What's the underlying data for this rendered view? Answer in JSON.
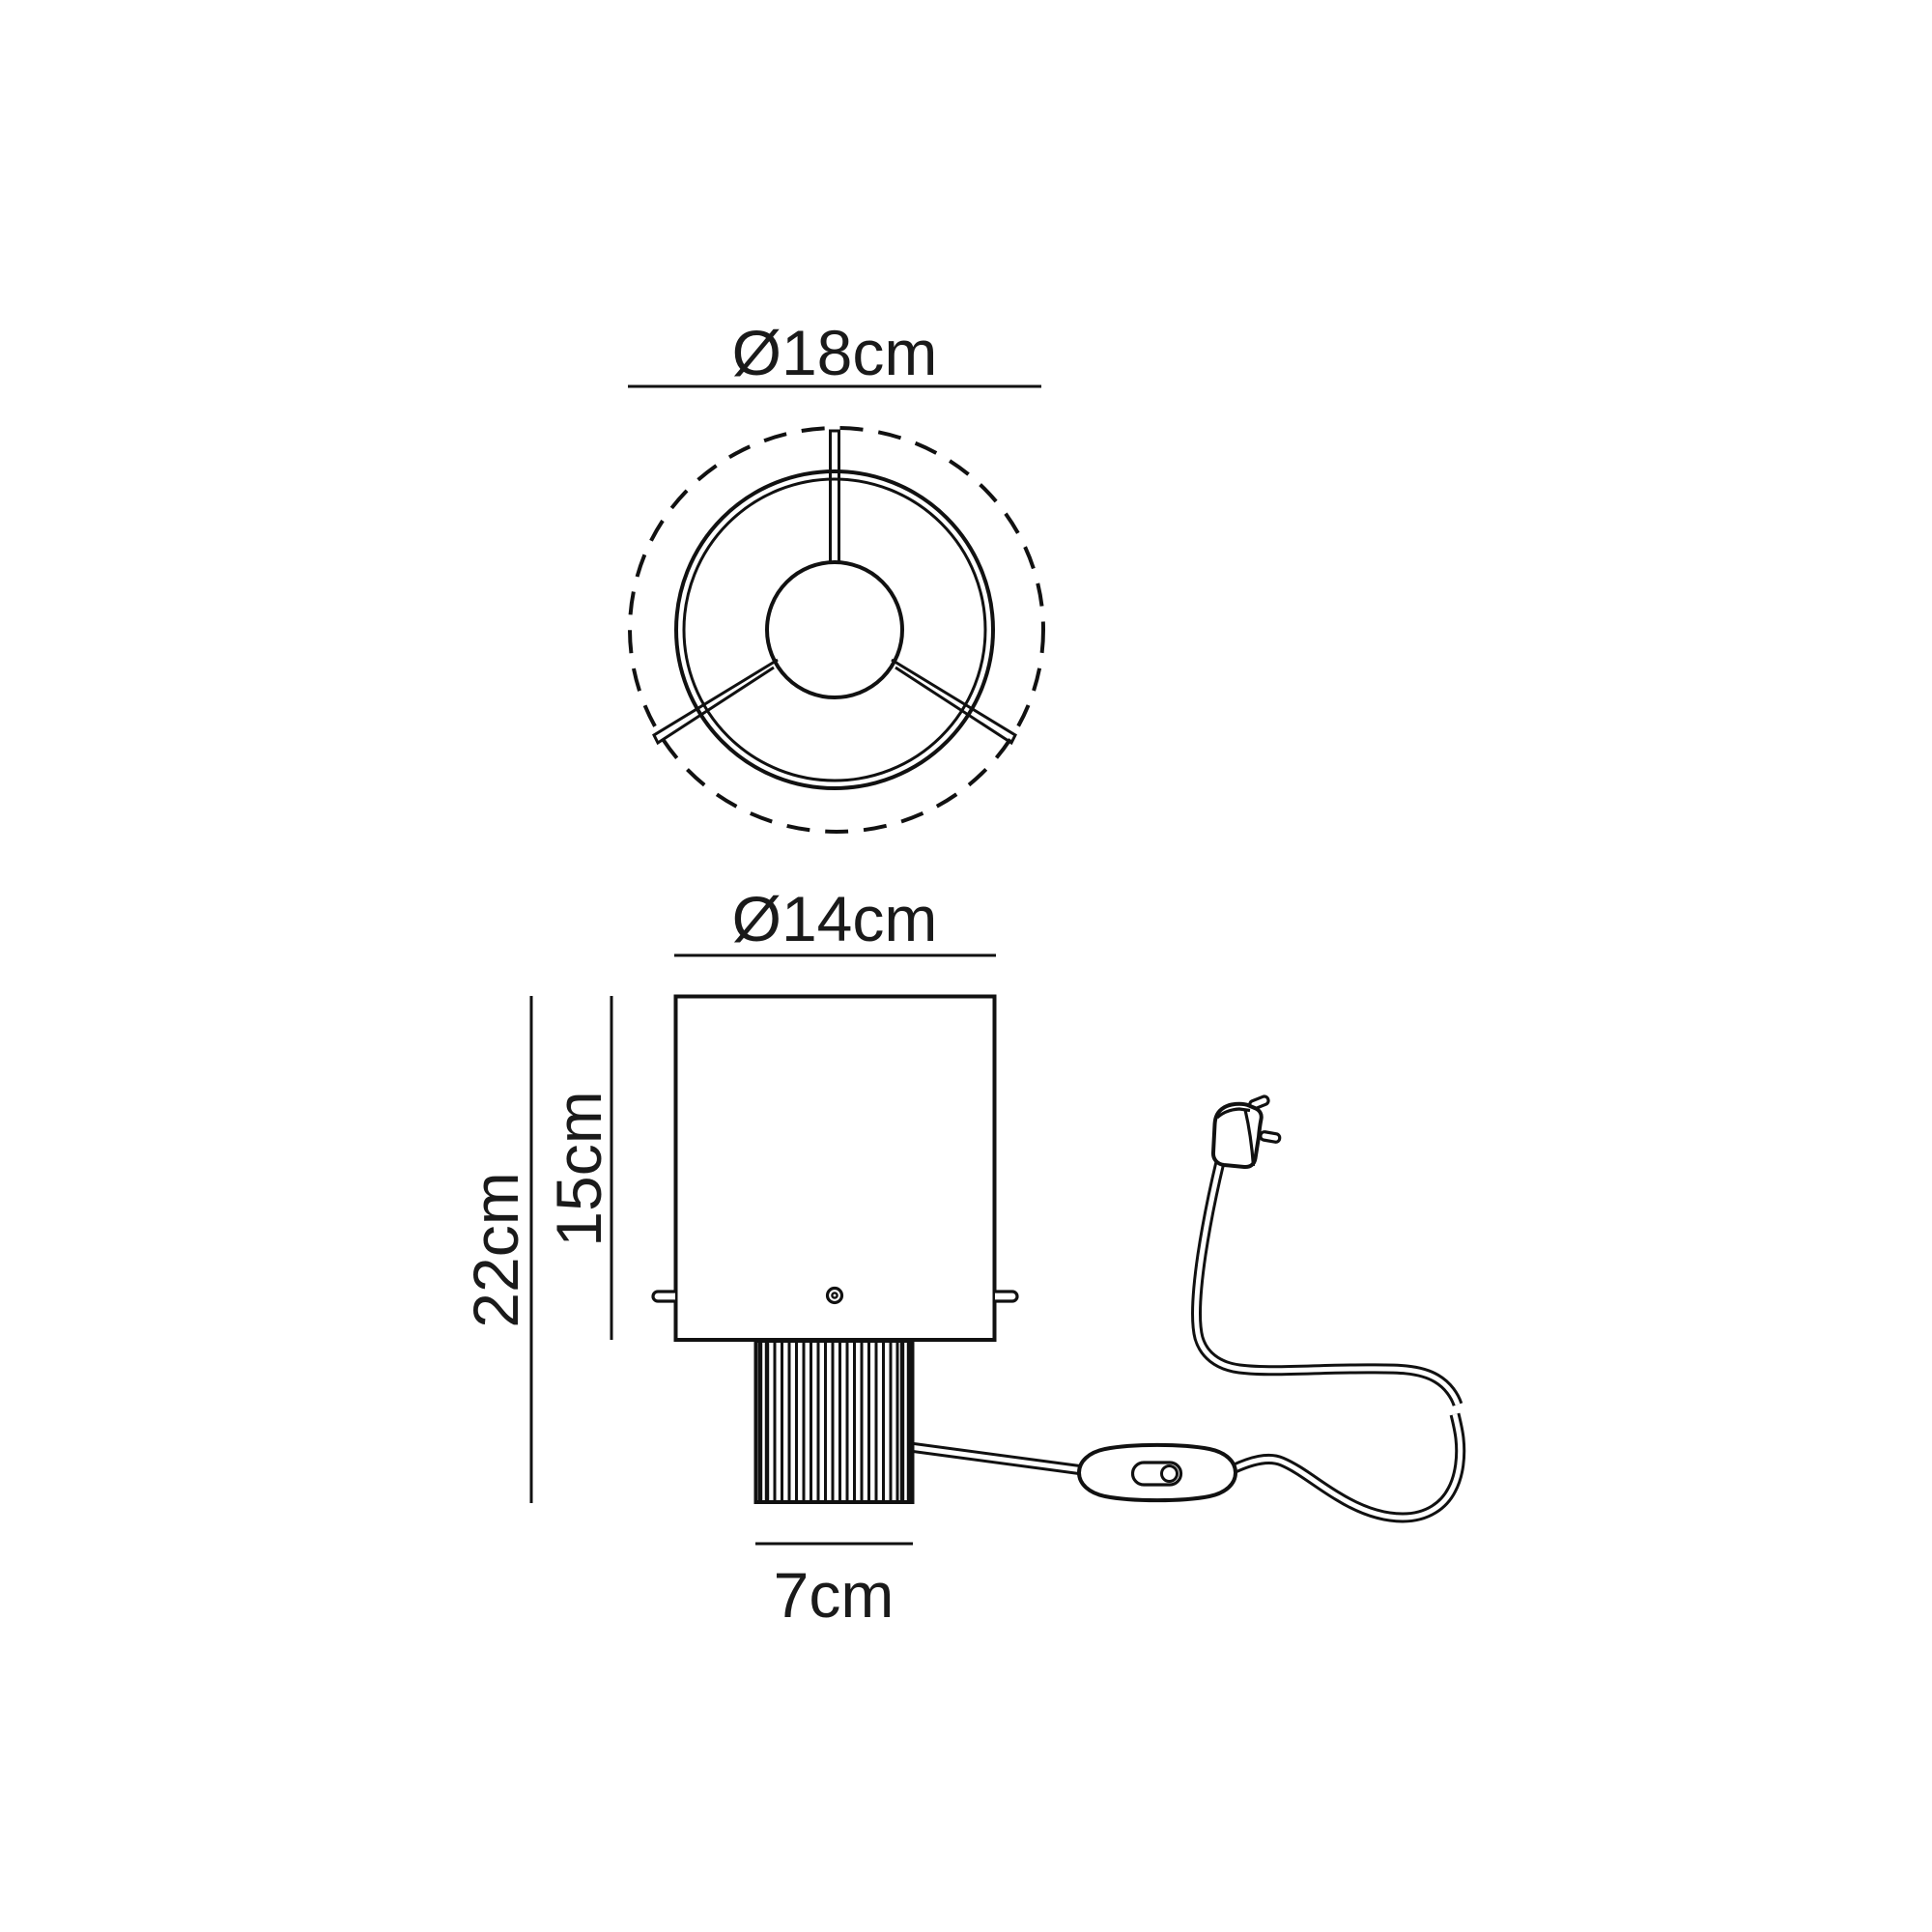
{
  "title": "Table lamp dimension drawing",
  "labels": {
    "top_diameter": "Ø18cm",
    "shade_diameter": "Ø14cm",
    "total_height": "22cm",
    "shade_height": "15cm",
    "base_width": "7cm"
  },
  "colors": {
    "line": "#111111",
    "background": "#ffffff"
  }
}
